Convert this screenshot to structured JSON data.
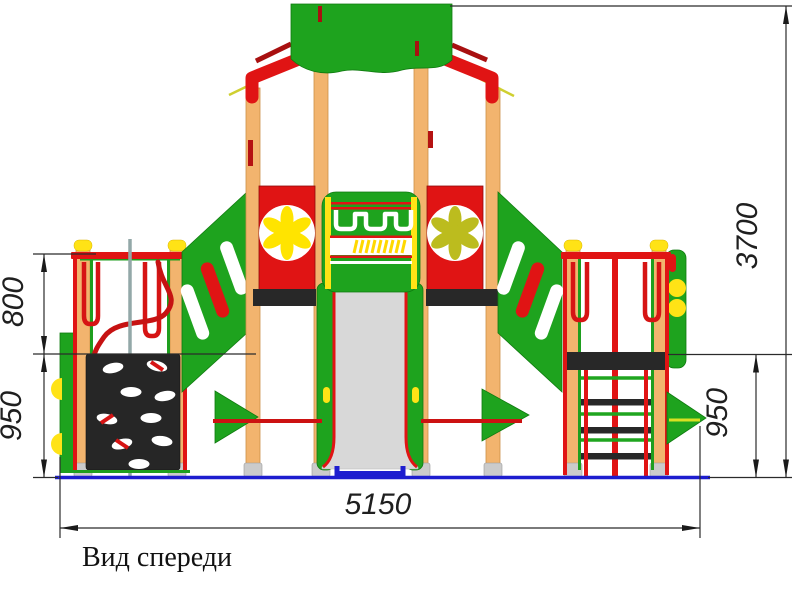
{
  "drawing": {
    "caption": "Вид спереди",
    "dimensions": {
      "left_upper_height": "800",
      "left_lower_height": "950",
      "right_height": "950",
      "total_height": "3700",
      "total_width": "5150"
    },
    "colors": {
      "structure_green": "#1ea31e",
      "frame_red": "#e01414",
      "post_wood": "#f2b46e",
      "accent_yellow": "#ffe000",
      "flower_olive": "#bcbc1e",
      "panel_black": "#282828",
      "slide_gray": "#d8d8d8",
      "ground_blue": "#1d1dcf",
      "dimension_line": "#2b2b2b"
    }
  }
}
